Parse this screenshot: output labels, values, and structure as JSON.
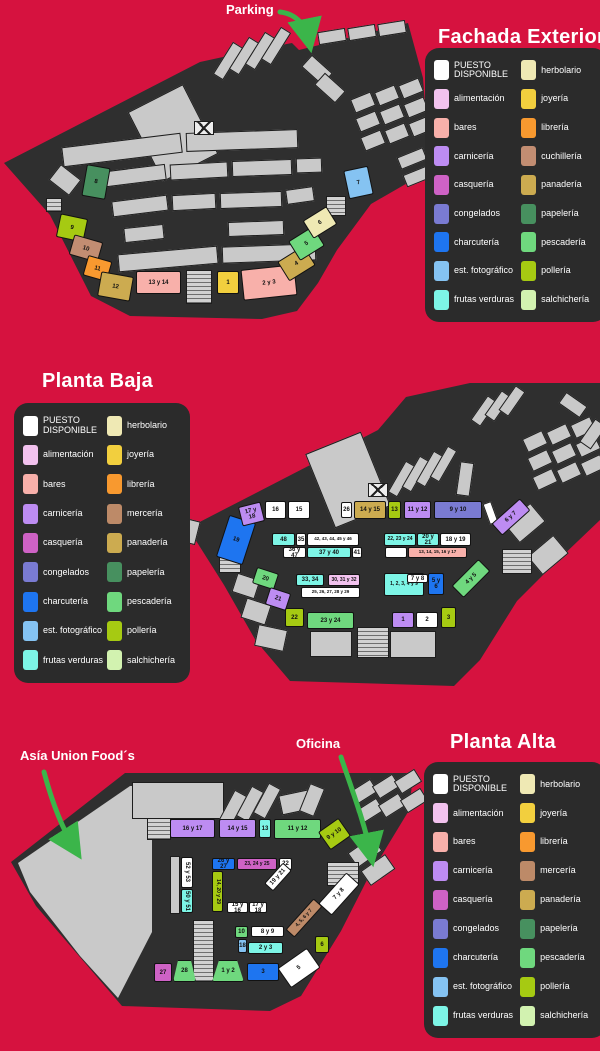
{
  "page": {
    "background": "#d6123f",
    "building_color": "#2f2f2f",
    "room_gray": "#c9c9c9",
    "panel_bg": "#2b2b2b",
    "arrow_green": "#3bb54a"
  },
  "categories": {
    "disponible": {
      "label": "PUESTO DISPONIBLE",
      "color": "#ffffff"
    },
    "alimentacion": {
      "label": "alimentación",
      "color": "#f2c2ee"
    },
    "bares": {
      "label": "bares",
      "color": "#f8b0aa"
    },
    "carniceria": {
      "label": "carnicería",
      "color": "#bd8cf2"
    },
    "casqueria": {
      "label": "casquería",
      "color": "#ce62c5"
    },
    "congelados": {
      "label": "congelados",
      "color": "#7a7bd2"
    },
    "charcuteria": {
      "label": "charcutería",
      "color": "#1e75f0"
    },
    "est_fotografico": {
      "label": "est. fotográfico",
      "color": "#85c3f2"
    },
    "frutas": {
      "label": "frutas verduras",
      "color": "#7df5e6"
    },
    "herbolario": {
      "label": "herbolario",
      "color": "#efe9b4"
    },
    "joyeria": {
      "label": "joyería",
      "color": "#f2cf3e"
    },
    "libreria": {
      "label": "librería",
      "color": "#f8992f"
    },
    "cuchilleria": {
      "label": "cuchillería",
      "color": "#c28d72"
    },
    "merceria": {
      "label": "mercería",
      "color": "#bd8a68"
    },
    "panaderia": {
      "label": "panadería",
      "color": "#ccab50"
    },
    "papeleria": {
      "label": "papelería",
      "color": "#47905f"
    },
    "pescaderia": {
      "label": "pescadería",
      "color": "#6fd87e"
    },
    "polleria": {
      "label": "pollería",
      "color": "#a6ca12"
    },
    "salchicheria": {
      "label": "salchichería",
      "color": "#d2f2b0"
    }
  },
  "annotations": {
    "parking": "Parking",
    "asia": "Asía Union Food´s",
    "oficina": "Oficina"
  },
  "sections": {
    "fachada": {
      "title": "Fachada Exterior",
      "legend_rows": [
        [
          "disponible",
          "herbolario"
        ],
        [
          "alimentacion",
          "joyeria"
        ],
        [
          "bares",
          "libreria"
        ],
        [
          "carniceria",
          "cuchilleria"
        ],
        [
          "casqueria",
          "panaderia"
        ],
        [
          "congelados",
          "papeleria"
        ],
        [
          "charcuteria",
          "pescaderia"
        ],
        [
          "est_fotografico",
          "polleria"
        ],
        [
          "frutas",
          "salchicheria"
        ]
      ],
      "stalls": [
        {
          "t": "8",
          "c": "papeleria",
          "x": 84,
          "y": 166,
          "w": 24,
          "h": 32,
          "r": 10
        },
        {
          "t": "9",
          "c": "polleria",
          "x": 58,
          "y": 216,
          "w": 28,
          "h": 24,
          "r": 12
        },
        {
          "t": "10",
          "c": "cuchilleria",
          "x": 71,
          "y": 238,
          "w": 30,
          "h": 21,
          "r": 16
        },
        {
          "t": "11",
          "c": "libreria",
          "x": 85,
          "y": 258,
          "w": 25,
          "h": 21,
          "r": 16
        },
        {
          "t": "12",
          "c": "panaderia",
          "x": 99,
          "y": 274,
          "w": 33,
          "h": 25,
          "r": 10
        },
        {
          "t": "13 y 14",
          "c": "bares",
          "x": 136,
          "y": 271,
          "w": 45,
          "h": 23,
          "r": 0
        },
        {
          "t": "1",
          "c": "joyeria",
          "x": 217,
          "y": 271,
          "w": 22,
          "h": 23,
          "r": 0
        },
        {
          "t": "2 y 3",
          "c": "bares",
          "x": 242,
          "y": 267,
          "w": 54,
          "h": 31,
          "r": -6
        },
        {
          "t": "4",
          "c": "panaderia",
          "x": 281,
          "y": 252,
          "w": 31,
          "h": 23,
          "r": -32
        },
        {
          "t": "5",
          "c": "pescaderia",
          "x": 292,
          "y": 232,
          "w": 29,
          "h": 23,
          "r": -32
        },
        {
          "t": "6",
          "c": "herbolario",
          "x": 306,
          "y": 212,
          "w": 28,
          "h": 21,
          "r": -32
        },
        {
          "t": "7",
          "c": "est_fotografico",
          "x": 346,
          "y": 168,
          "w": 25,
          "h": 29,
          "r": -12
        }
      ]
    },
    "baja": {
      "title": "Planta Baja",
      "legend_rows": [
        [
          "disponible",
          "herbolario"
        ],
        [
          "alimentacion",
          "joyeria"
        ],
        [
          "bares",
          "libreria"
        ],
        [
          "carniceria",
          "merceria"
        ],
        [
          "casqueria",
          "panaderia"
        ],
        [
          "congelados",
          "papeleria"
        ],
        [
          "charcuteria",
          "pescaderia"
        ],
        [
          "est_fotografico",
          "polleria"
        ],
        [
          "frutas",
          "salchicheria"
        ]
      ],
      "stalls": [
        {
          "t": "19",
          "c": "charcuteria",
          "x": 222,
          "y": 518,
          "w": 28,
          "h": 44,
          "r": 18
        },
        {
          "t": "17 y 18",
          "c": "carniceria",
          "x": 240,
          "y": 504,
          "w": 23,
          "h": 20,
          "r": -14
        },
        {
          "t": "16",
          "c": "disponible",
          "x": 265,
          "y": 501,
          "w": 21,
          "h": 18,
          "r": 0
        },
        {
          "t": "15",
          "c": "disponible",
          "x": 288,
          "y": 501,
          "w": 22,
          "h": 18,
          "r": 0
        },
        {
          "t": "26",
          "c": "disponible",
          "x": 341,
          "y": 502,
          "w": 11,
          "h": 16,
          "r": 0
        },
        {
          "t": "14 y 15",
          "c": "panaderia",
          "x": 354,
          "y": 501,
          "w": 32,
          "h": 18,
          "r": 0
        },
        {
          "t": "13",
          "c": "polleria",
          "x": 388,
          "y": 501,
          "w": 13,
          "h": 18,
          "r": 0
        },
        {
          "t": "11 y 12",
          "c": "carniceria",
          "x": 404,
          "y": 501,
          "w": 27,
          "h": 18,
          "r": 0
        },
        {
          "t": "9 y 10",
          "c": "congelados",
          "x": 434,
          "y": 501,
          "w": 48,
          "h": 18,
          "r": 0
        },
        {
          "t": "6 y 7",
          "c": "carniceria",
          "x": 492,
          "y": 509,
          "w": 38,
          "h": 16,
          "r": -42
        },
        {
          "t": "48",
          "c": "frutas",
          "x": 272,
          "y": 533,
          "w": 23,
          "h": 13,
          "r": 0
        },
        {
          "t": "35",
          "c": "disponible",
          "x": 296,
          "y": 533,
          "w": 10,
          "h": 13,
          "r": 0
        },
        {
          "t": "42, 43, 44, 45 y 46",
          "c": "disponible",
          "x": 307,
          "y": 533,
          "w": 52,
          "h": 13,
          "r": 0
        },
        {
          "t": "36 y 47",
          "c": "disponible",
          "x": 283,
          "y": 547,
          "w": 23,
          "h": 11,
          "r": 0
        },
        {
          "t": "37 y 40",
          "c": "frutas",
          "x": 307,
          "y": 547,
          "w": 44,
          "h": 11,
          "r": 0
        },
        {
          "t": "41",
          "c": "disponible",
          "x": 352,
          "y": 547,
          "w": 10,
          "h": 11,
          "r": 0
        },
        {
          "t": "22, 23 y 24",
          "c": "frutas",
          "x": 384,
          "y": 533,
          "w": 32,
          "h": 13,
          "r": 0
        },
        {
          "t": "20 y 21",
          "c": "frutas",
          "x": 417,
          "y": 533,
          "w": 22,
          "h": 13,
          "r": 0
        },
        {
          "t": "18 y 19",
          "c": "disponible",
          "x": 440,
          "y": 533,
          "w": 31,
          "h": 13,
          "r": 0
        },
        {
          "t": "",
          "c": "disponible",
          "x": 385,
          "y": 547,
          "w": 22,
          "h": 11,
          "r": 0
        },
        {
          "t": "13, 14, 15, 16 y 17",
          "c": "bares",
          "x": 408,
          "y": 547,
          "w": 59,
          "h": 11,
          "r": 0
        },
        {
          "t": "33, 34",
          "c": "frutas",
          "x": 296,
          "y": 574,
          "w": 28,
          "h": 12,
          "r": 0
        },
        {
          "t": "30, 31 y 32",
          "c": "alimentacion",
          "x": 328,
          "y": 574,
          "w": 32,
          "h": 12,
          "r": 0
        },
        {
          "t": "25, 26, 27, 28 y 29",
          "c": "disponible",
          "x": 301,
          "y": 587,
          "w": 59,
          "h": 11,
          "r": 0
        },
        {
          "t": "1, 2, 3, 4 y 9",
          "c": "frutas",
          "x": 384,
          "y": 573,
          "w": 40,
          "h": 23,
          "r": 0
        },
        {
          "t": "7 y 8",
          "c": "disponible",
          "x": 407,
          "y": 574,
          "w": 21,
          "h": 9,
          "r": 0
        },
        {
          "t": "5 y 6",
          "c": "charcuteria",
          "x": 428,
          "y": 573,
          "w": 16,
          "h": 22,
          "r": 0
        },
        {
          "t": "4 y 5",
          "c": "pescaderia",
          "x": 452,
          "y": 570,
          "w": 38,
          "h": 17,
          "r": -45
        },
        {
          "t": "20",
          "c": "pescaderia",
          "x": 254,
          "y": 570,
          "w": 23,
          "h": 17,
          "r": 18
        },
        {
          "t": "21",
          "c": "carniceria",
          "x": 267,
          "y": 590,
          "w": 22,
          "h": 18,
          "r": 18
        },
        {
          "t": "22",
          "c": "polleria",
          "x": 285,
          "y": 608,
          "w": 19,
          "h": 19,
          "r": 0
        },
        {
          "t": "23 y 24",
          "c": "pescaderia",
          "x": 307,
          "y": 612,
          "w": 47,
          "h": 17,
          "r": 0
        },
        {
          "t": "1",
          "c": "carniceria",
          "x": 392,
          "y": 612,
          "w": 22,
          "h": 16,
          "r": 0
        },
        {
          "t": "2",
          "c": "disponible",
          "x": 416,
          "y": 612,
          "w": 22,
          "h": 16,
          "r": 0
        },
        {
          "t": "3",
          "c": "polleria",
          "x": 441,
          "y": 607,
          "w": 15,
          "h": 21,
          "r": 0
        }
      ]
    },
    "alta": {
      "title": "Planta Alta",
      "legend_rows": [
        [
          "disponible",
          "herbolario"
        ],
        [
          "alimentacion",
          "joyeria"
        ],
        [
          "bares",
          "libreria"
        ],
        [
          "carniceria",
          "merceria"
        ],
        [
          "casqueria",
          "panaderia"
        ],
        [
          "congelados",
          "papeleria"
        ],
        [
          "charcuteria",
          "pescaderia"
        ],
        [
          "est_fotografico",
          "polleria"
        ],
        [
          "frutas",
          "salchicheria"
        ]
      ],
      "stalls": [
        {
          "t": "16 y 17",
          "c": "carniceria",
          "x": 170,
          "y": 819,
          "w": 45,
          "h": 19,
          "r": 0
        },
        {
          "t": "14 y 15",
          "c": "carniceria",
          "x": 219,
          "y": 819,
          "w": 37,
          "h": 19,
          "r": 0
        },
        {
          "t": "13",
          "c": "frutas",
          "x": 259,
          "y": 819,
          "w": 12,
          "h": 19,
          "r": 0
        },
        {
          "t": "11 y 12",
          "c": "pescaderia",
          "x": 274,
          "y": 819,
          "w": 47,
          "h": 20,
          "r": 0
        },
        {
          "t": "9 y 10",
          "c": "polleria",
          "x": 322,
          "y": 823,
          "w": 25,
          "h": 22,
          "r": -35
        },
        {
          "t": "52 y 53",
          "c": "disponible",
          "x": 181,
          "y": 857,
          "w": 12,
          "h": 31,
          "r": 0,
          "v": 1
        },
        {
          "t": "50 y 51",
          "c": "frutas",
          "x": 181,
          "y": 889,
          "w": 12,
          "h": 24,
          "r": 0,
          "v": 1
        },
        {
          "t": "26 y 27",
          "c": "charcuteria",
          "x": 212,
          "y": 858,
          "w": 23,
          "h": 12,
          "r": 0
        },
        {
          "t": "23, 24 y 25",
          "c": "casqueria",
          "x": 237,
          "y": 858,
          "w": 40,
          "h": 12,
          "r": 0
        },
        {
          "t": "22",
          "c": "disponible",
          "x": 279,
          "y": 858,
          "w": 13,
          "h": 12,
          "r": 0
        },
        {
          "t": "14, 20 y 29",
          "c": "polleria",
          "x": 212,
          "y": 871,
          "w": 11,
          "h": 41,
          "r": 0,
          "v": 1
        },
        {
          "t": "19 y 21",
          "c": "disponible",
          "x": 264,
          "y": 871,
          "w": 28,
          "h": 12,
          "r": -48
        },
        {
          "t": "15 y 16",
          "c": "disponible",
          "x": 227,
          "y": 902,
          "w": 21,
          "h": 11,
          "r": 0
        },
        {
          "t": "17 y 18",
          "c": "disponible",
          "x": 249,
          "y": 902,
          "w": 18,
          "h": 11,
          "r": 0
        },
        {
          "t": "7 y 8",
          "c": "disponible",
          "x": 318,
          "y": 885,
          "w": 42,
          "h": 18,
          "r": -48
        },
        {
          "t": "4, 5, 6 y 7",
          "c": "merceria",
          "x": 283,
          "y": 912,
          "w": 42,
          "h": 12,
          "r": -48
        },
        {
          "t": "8 y 9",
          "c": "disponible",
          "x": 251,
          "y": 926,
          "w": 33,
          "h": 11,
          "r": 0
        },
        {
          "t": "10",
          "c": "pescaderia",
          "x": 235,
          "y": 926,
          "w": 13,
          "h": 12,
          "r": 0
        },
        {
          "t": "18",
          "c": "est_fotografico",
          "x": 238,
          "y": 939,
          "w": 9,
          "h": 14,
          "r": 0
        },
        {
          "t": "2 y 3",
          "c": "frutas",
          "x": 248,
          "y": 942,
          "w": 35,
          "h": 12,
          "r": 0
        },
        {
          "t": "6",
          "c": "polleria",
          "x": 315,
          "y": 936,
          "w": 14,
          "h": 17,
          "r": 0
        },
        {
          "t": "27",
          "c": "casqueria",
          "x": 154,
          "y": 963,
          "w": 18,
          "h": 19,
          "r": 0
        },
        {
          "t": "28",
          "c": "pescaderia",
          "x": 173,
          "y": 960,
          "w": 23,
          "h": 22,
          "r": 0,
          "s": "trap"
        },
        {
          "t": "1 y 2",
          "c": "pescaderia",
          "x": 212,
          "y": 960,
          "w": 32,
          "h": 22,
          "r": 0,
          "s": "trap"
        },
        {
          "t": "3",
          "c": "charcuteria",
          "x": 247,
          "y": 963,
          "w": 32,
          "h": 18,
          "r": 0
        },
        {
          "t": "5",
          "c": "disponible",
          "x": 281,
          "y": 956,
          "w": 36,
          "h": 24,
          "r": -35
        }
      ]
    }
  }
}
